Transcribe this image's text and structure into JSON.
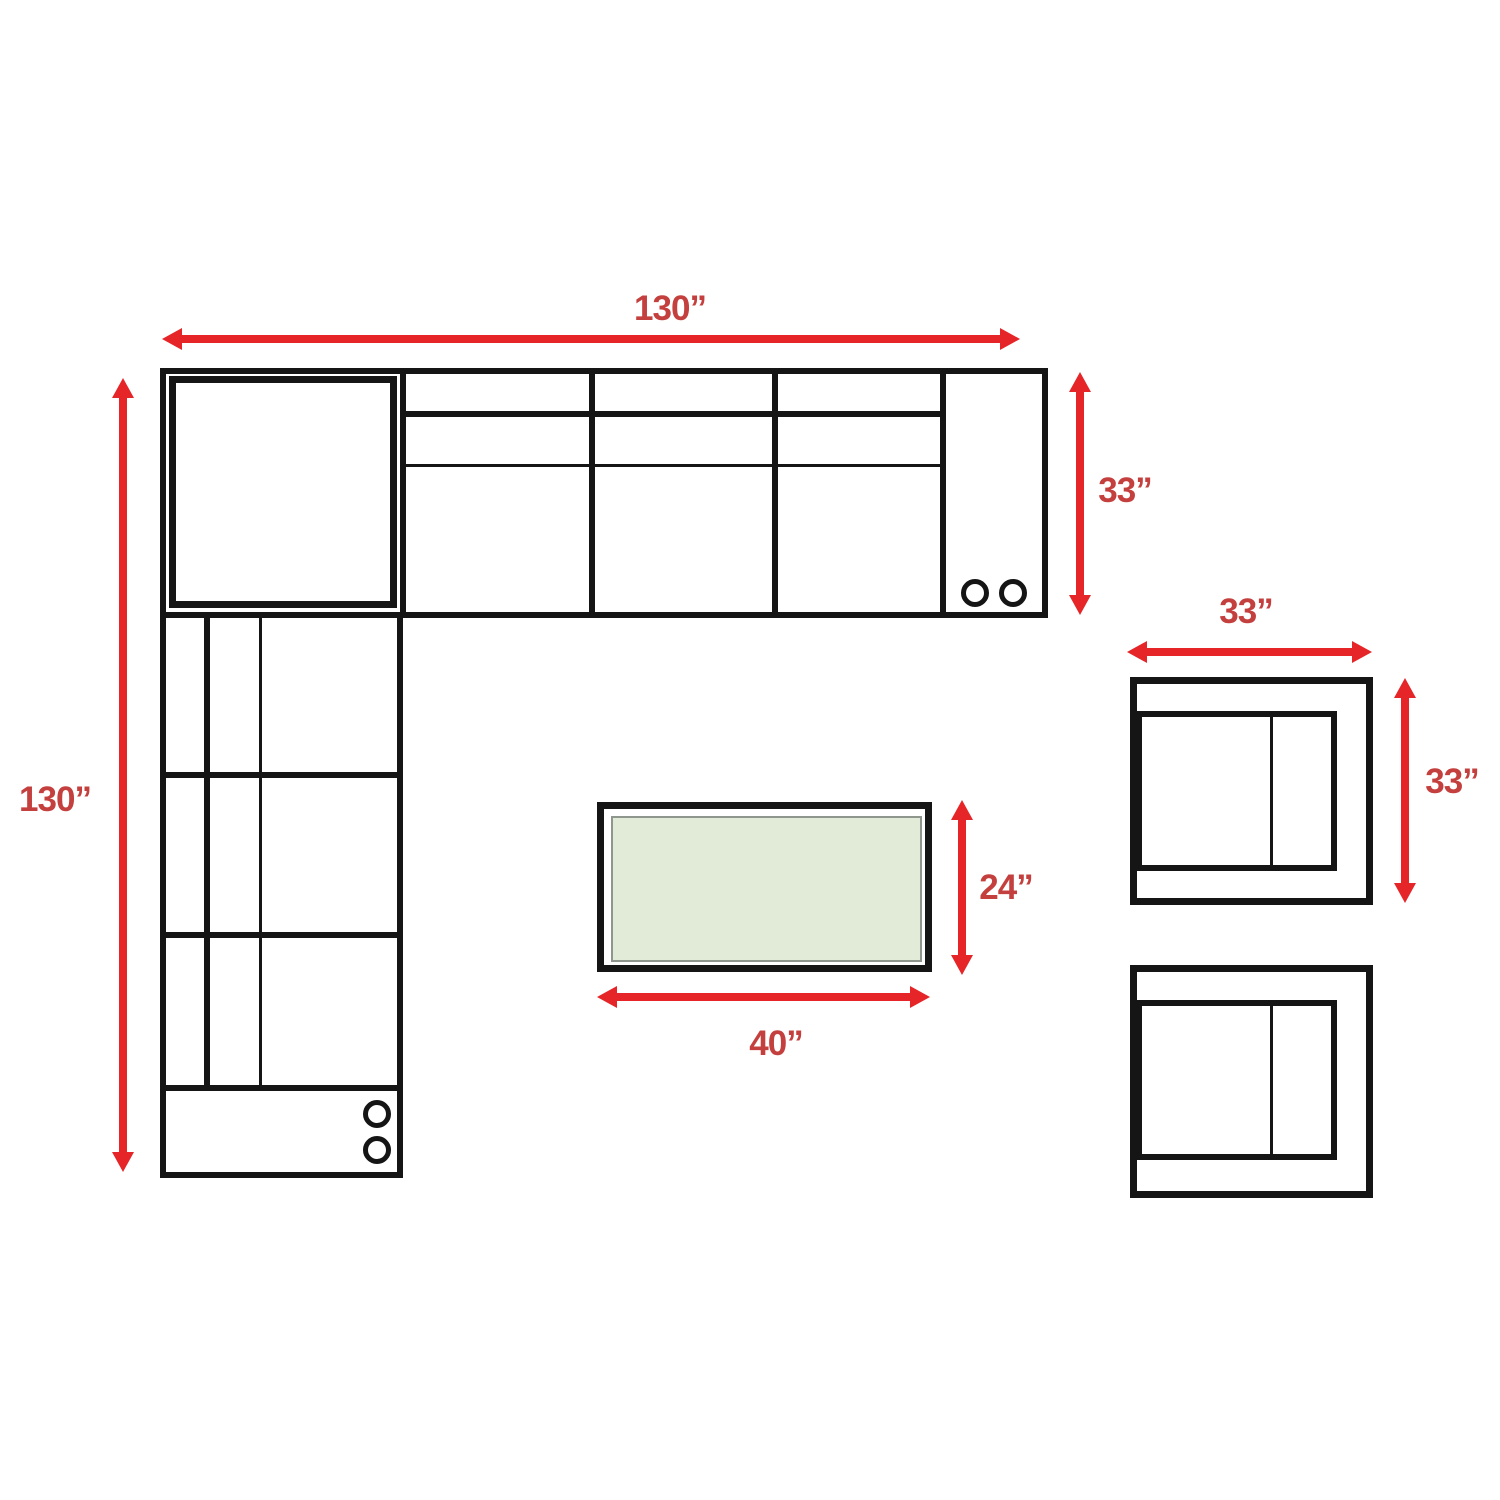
{
  "colors": {
    "bg": "#ffffff",
    "outline": "#151515",
    "arrow": "#e52528",
    "label": "#c4403e",
    "table_fill": "#e2ebd7",
    "table_border": "#8f968d"
  },
  "icons": {
    "cupholder": "circle"
  },
  "pieces": {
    "sectional": {
      "width_label": "130”",
      "height_label": "130”",
      "depth_label": "33”"
    },
    "armchair": {
      "width_label": "33”",
      "depth_label": "33”"
    },
    "coffee_table": {
      "width_label": "40”",
      "depth_label": "24”"
    }
  }
}
